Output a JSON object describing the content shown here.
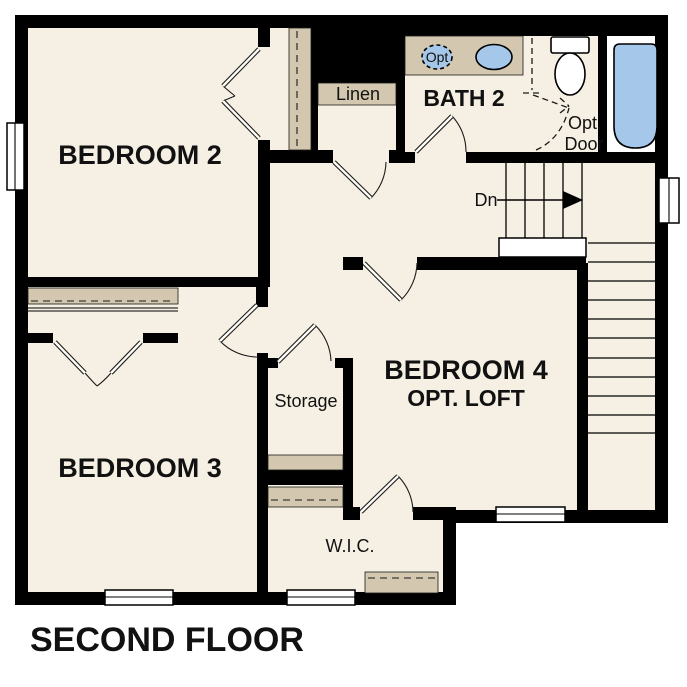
{
  "title": "SECOND FLOOR",
  "rooms": {
    "bedroom2": {
      "label": "BEDROOM 2"
    },
    "bedroom3": {
      "label": "BEDROOM 3"
    },
    "bedroom4": {
      "label": "BEDROOM 4",
      "sublabel": "OPT. LOFT"
    },
    "bath2": {
      "label": "BATH 2"
    },
    "linen": {
      "label": "Linen"
    },
    "storage": {
      "label": "Storage"
    },
    "wic": {
      "label": "W.I.C."
    }
  },
  "annotations": {
    "stairs_down": "Dn",
    "opt_door_line1": "Opt.",
    "opt_door_line2": "Door",
    "opt_sink": "Opt"
  },
  "colors": {
    "floor": "#f6efe3",
    "wall": "#000000",
    "shelf": "#d3c8af",
    "blue": "#a5c7e9",
    "text": "#111111"
  }
}
